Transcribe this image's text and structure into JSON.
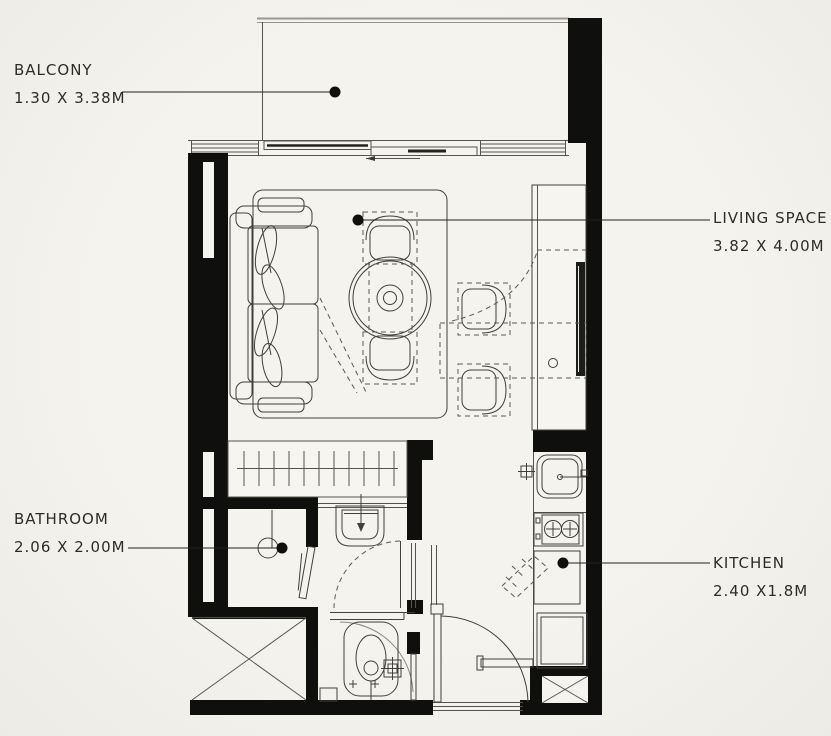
{
  "canvas": {
    "background": "#f2f1ec",
    "wall_color": "#0f0f0e",
    "line_color": "#413f3a"
  },
  "rooms": {
    "balcony": {
      "label": "BALCONY",
      "dims": "1.30 X 3.38M"
    },
    "living": {
      "label": "LIVING SPACE",
      "dims": "3.82 X 4.00M"
    },
    "bathroom": {
      "label": "BATHROOM",
      "dims": "2.06 X 2.00M"
    },
    "kitchen": {
      "label": "KITCHEN",
      "dims": "2.40 X1.8M"
    }
  }
}
